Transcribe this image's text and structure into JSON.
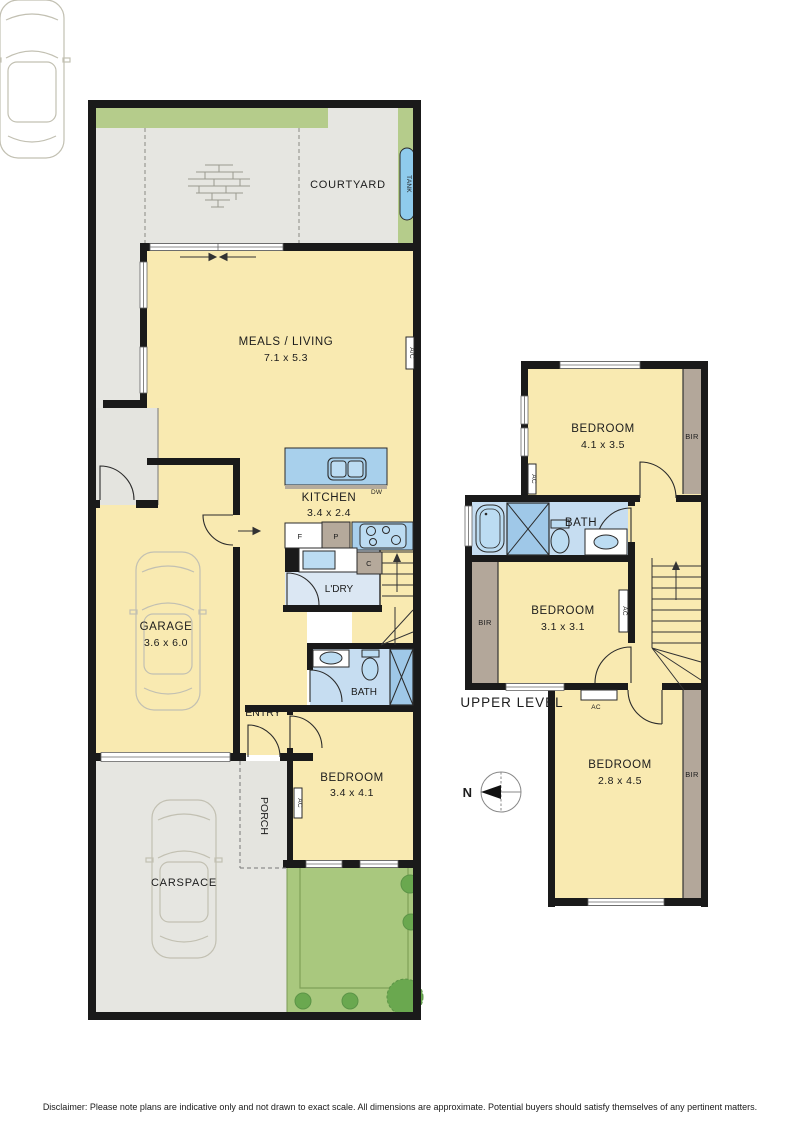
{
  "labels": {
    "ac": "AC",
    "ac_slash": "A/C",
    "bir": "BIR",
    "dw": "DW",
    "tank": "TANK",
    "fridge": "F",
    "pantry": "P",
    "cupboard": "C",
    "north": "N"
  },
  "ground_floor": {
    "courtyard": "COURTYARD",
    "meals_living": {
      "name": "MEALS / LIVING",
      "dims": "7.1 x 5.3"
    },
    "kitchen": {
      "name": "KITCHEN",
      "dims": "3.4 x 2.4"
    },
    "laundry": "L'DRY",
    "bath": "BATH",
    "entry": "ENTRY",
    "garage": {
      "name": "GARAGE",
      "dims": "3.6 x 6.0"
    },
    "porch": "PORCH",
    "bedroom": {
      "name": "BEDROOM",
      "dims": "3.4 x 4.1"
    },
    "carspace": "CARSPACE"
  },
  "upper_level": {
    "title": "UPPER LEVEL",
    "bedroom1": {
      "name": "BEDROOM",
      "dims": "4.1 x 3.5"
    },
    "bath": "BATH",
    "bedroom2": {
      "name": "BEDROOM",
      "dims": "3.1 x 3.1"
    },
    "bedroom3": {
      "name": "BEDROOM",
      "dims": "2.8 x 4.5"
    }
  },
  "disclaimer": "Disclaimer: Please note plans are indicative only and not drawn to exact scale. All dimensions are approximate. Potential buyers should satisfy themselves of any pertinent matters.",
  "colors": {
    "room_yellow": "#f9eab1",
    "outdoor_grey": "#e6e6e1",
    "wet_blue": "#c6ddf1",
    "fixture_blue": "#9fc8e8",
    "grass_green": "#b5cc8b",
    "garden_green": "#a9c87e",
    "tree_green": "#6aa84f",
    "robe_brown": "#b3a79a",
    "tank_blue": "#8fcbec",
    "wall_black": "#1a1a1a"
  }
}
